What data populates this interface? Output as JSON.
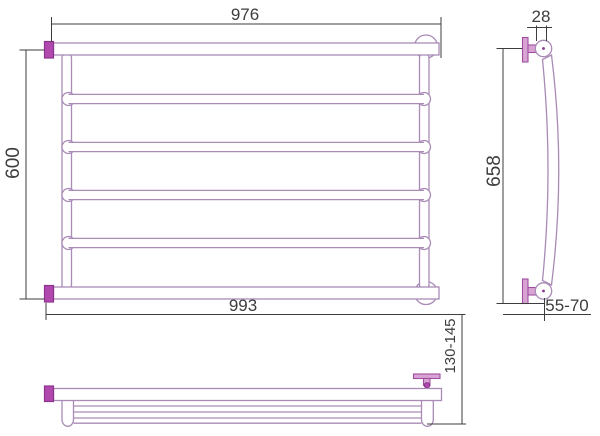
{
  "dimensions": {
    "front_top_width": "976",
    "front_height": "600",
    "front_bottom_width": "993",
    "side_tube_diameter": "28",
    "side_height": "658",
    "side_wall_offset": "55-70",
    "plan_depth": "130-145"
  },
  "colors": {
    "tube_outline": "#a98bb6",
    "fitting_fill": "#b148ae",
    "fitting_stroke": "#8c3390",
    "bracket_fill": "#d9a4d4",
    "dimension_line": "#3d3d3d",
    "background": "#ffffff"
  }
}
